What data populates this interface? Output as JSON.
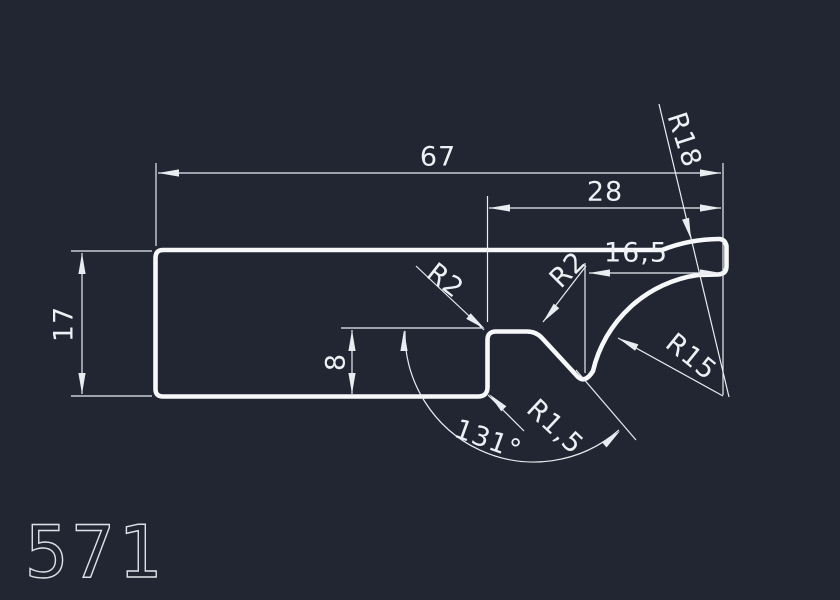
{
  "app": {
    "background_color": "#212632",
    "line_color": "#f7f8fa"
  },
  "drawing": {
    "part_label": "571",
    "dimensions": {
      "total_width": "67",
      "right_width": "28",
      "left_height": "17",
      "step_height": "8",
      "right_length": "16,5",
      "notch_angle": "131°"
    },
    "radii": {
      "plateau_left": "R2",
      "plateau_right": "R2",
      "step_bottom": "R1,5",
      "inner_curve": "R15",
      "outer_curve": "R18"
    }
  }
}
